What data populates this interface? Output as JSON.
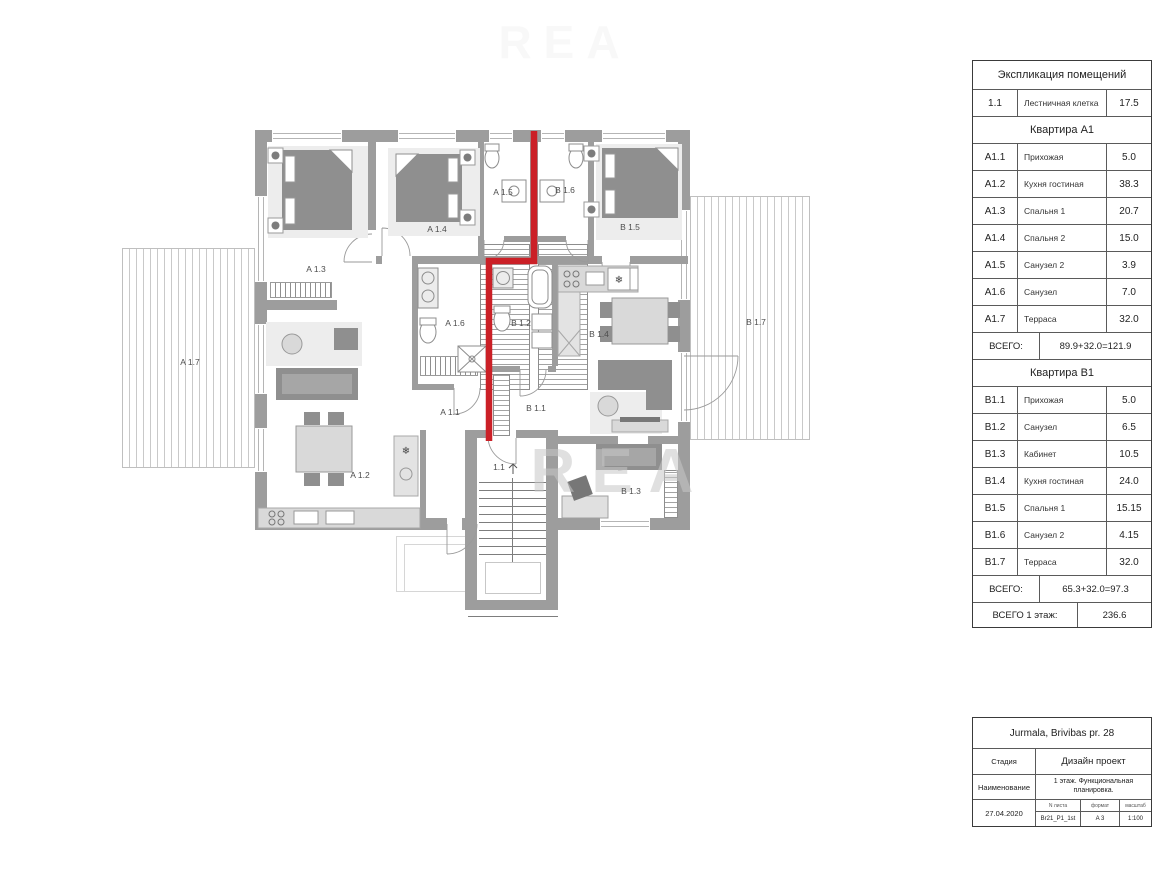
{
  "plan": {
    "watermark": "REA",
    "labels": {
      "a17": "A 1.7",
      "a13": "A 1.3",
      "a14": "A 1.4",
      "a15": "A 1.5",
      "b16": "B 1.6",
      "b15": "B 1.5",
      "b17": "B 1.7",
      "a16": "A 1.6",
      "b12": "B 1.2",
      "b14": "B 1.4",
      "a11": "A 1.1",
      "b11": "B 1.1",
      "a12": "A 1.2",
      "stair": "1.1",
      "b13": "B 1.3"
    },
    "colors": {
      "red_line": "#cb2027",
      "wall": "#9d9d9d"
    }
  },
  "explication": {
    "title": "Экспликация помещений",
    "stair_row": {
      "id": "1.1",
      "name": "Лестничная клетка",
      "area": "17.5"
    },
    "apartment_a": {
      "header": "Квартира А1",
      "rows": [
        {
          "id": "A1.1",
          "name": "Прихожая",
          "area": "5.0"
        },
        {
          "id": "A1.2",
          "name": "Кухня гостиная",
          "area": "38.3"
        },
        {
          "id": "A1.3",
          "name": "Спальня 1",
          "area": "20.7"
        },
        {
          "id": "A1.4",
          "name": "Спальня 2",
          "area": "15.0"
        },
        {
          "id": "A1.5",
          "name": "Санузел 2",
          "area": "3.9"
        },
        {
          "id": "A1.6",
          "name": "Санузел",
          "area": "7.0"
        },
        {
          "id": "A1.7",
          "name": "Терраса",
          "area": "32.0"
        }
      ],
      "total_label": "ВСЕГО:",
      "total_value": "89.9+32.0=121.9"
    },
    "apartment_b": {
      "header": "Квартира В1",
      "rows": [
        {
          "id": "B1.1",
          "name": "Прихожая",
          "area": "5.0"
        },
        {
          "id": "B1.2",
          "name": "Санузел",
          "area": "6.5"
        },
        {
          "id": "B1.3",
          "name": "Кабинет",
          "area": "10.5"
        },
        {
          "id": "B1.4",
          "name": "Кухня гостиная",
          "area": "24.0"
        },
        {
          "id": "B1.5",
          "name": "Спальня 1",
          "area": "15.15"
        },
        {
          "id": "B1.6",
          "name": "Санузел 2",
          "area": "4.15"
        },
        {
          "id": "B1.7",
          "name": "Терраса",
          "area": "32.0"
        }
      ],
      "total_label": "ВСЕГО:",
      "total_value": "65.3+32.0=97.3"
    },
    "grand_total": {
      "label": "ВСЕГО 1 этаж:",
      "value": "236.6"
    }
  },
  "title_block": {
    "project": "Jurmala, Brivibas pr. 28",
    "stage_label": "Стадия",
    "stage_value": "Дизайн проект",
    "name_label": "Наименование",
    "name_value": "1 этаж. Функциональная планировка.",
    "date": "27.04.2020",
    "sheet_label": "N листа",
    "sheet_value": "Br21_P1_1st",
    "format_label": "формат",
    "format_value": "A 3",
    "scale_label": "масштаб",
    "scale_value": "1:100"
  }
}
